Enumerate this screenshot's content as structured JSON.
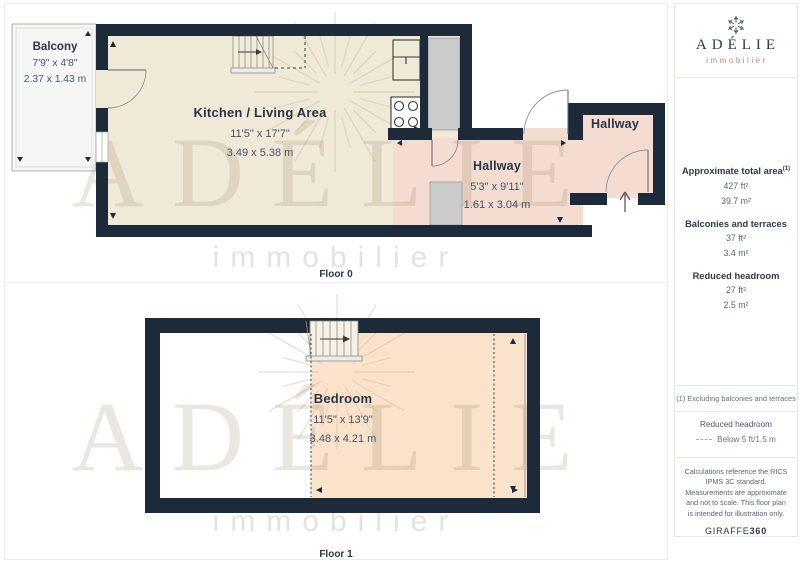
{
  "floor0": {
    "label": "Floor 0",
    "balcony": {
      "name": "Balcony",
      "dim_imperial": "7'9\" x 4'8\"",
      "dim_metric": "2.37 x 1.43 m"
    },
    "kitchen_living": {
      "name": "Kitchen / Living Area",
      "dim_imperial": "11'5\" x 17'7\"",
      "dim_metric": "3.49 x 5.38 m"
    },
    "hallway_main": {
      "name": "Hallway",
      "dim_imperial": "5'3\" x 9'11\"",
      "dim_metric": "1.61 x 3.04 m"
    },
    "hallway_entry": {
      "name": "Hallway"
    }
  },
  "floor1": {
    "label": "Floor 1",
    "bedroom": {
      "name": "Bedroom",
      "dim_imperial": "11'5\" x 13'9\"",
      "dim_metric": "3.48 x 4.21 m"
    }
  },
  "watermark": {
    "title": "ADÉLIE",
    "subtitle": "immobilier"
  },
  "sidebar": {
    "logo": {
      "brand": "ADÉLIE",
      "tagline": "immobilier"
    },
    "areas": {
      "total": {
        "label": "Approximate total area",
        "superscript": "(1)",
        "ft": "427 ft²",
        "m": "39.7 m²"
      },
      "balconies": {
        "label": "Balconies and terraces",
        "ft": "37 ft²",
        "m": "3.4 m²"
      },
      "reduced": {
        "label": "Reduced headroom",
        "ft": "27 ft²",
        "m": "2.5 m²"
      }
    },
    "footnote": "(1) Excluding balconies and terraces",
    "legend": {
      "title": "Reduced headroom",
      "entry": "Below 5 ft/1.5 m"
    },
    "disclaimer": "Calculations reference the RICS IPMS 3C standard. Measurements are approximate and not to scale. This floor plan is intended for illustration only.",
    "brand_footer": {
      "normal": "GIRAFFE",
      "bold": "360"
    }
  },
  "colors": {
    "wall": "#1d2a39",
    "kitchen_floor": "#f0e9d7",
    "hallway_floor": "#f4dcd1",
    "bedroom_floor": "#fbe3cb",
    "balcony_floor": "#f6f6f4",
    "closet_gray": "#cbcbcb",
    "brand_navy": "#2b394c",
    "brand_salmon": "#c9837a",
    "watermark_tan": "#8a7b55"
  }
}
